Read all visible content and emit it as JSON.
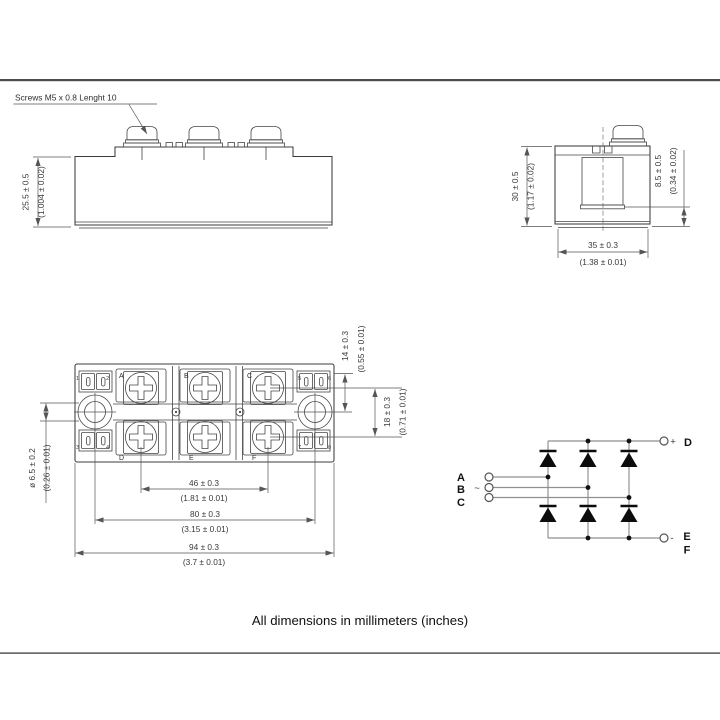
{
  "page": {
    "note_screws": "Screws M5 x 0.8 Lenght 10",
    "caption": "All dimensions in millimeters (inches)"
  },
  "colors": {
    "line": "#3c3c3c",
    "dim": "#555555",
    "wire": "#8f8f8f",
    "ink": "#111111"
  },
  "side_view": {
    "height_mm": "25.5 ± 0.5",
    "height_in": "(1.004 ± 0.02)"
  },
  "end_view": {
    "height_mm": "30 ± 0.5",
    "height_in": "(1.17 ± 0.02)",
    "tab_mm": "8.5 ± 0.5",
    "tab_in": "(0.34 ± 0.02)",
    "width_mm": "35 ± 0.3",
    "width_in": "(1.38 ± 0.01)"
  },
  "top_view": {
    "terminals": [
      "A",
      "B",
      "C",
      "D",
      "E",
      "F"
    ],
    "pins": [
      "1",
      "2",
      "3",
      "4",
      "5",
      "6",
      "7",
      "8"
    ],
    "hole_mm": "ø 6.5 ± 0.2",
    "hole_in": "(0.26 ± 0.01)",
    "tab_offset_mm": "14 ± 0.3",
    "tab_offset_in": "(0.55 ± 0.01)",
    "row_pitch_mm": "18 ± 0.3",
    "row_pitch_in": "(0.71 ± 0.01)",
    "span46_mm": "46 ± 0.3",
    "span46_in": "(1.81 ± 0.01)",
    "span80_mm": "80 ± 0.3",
    "span80_in": "(3.15 ± 0.01)",
    "span94_mm": "94 ± 0.3",
    "span94_in": "(3.7 ± 0.01)"
  },
  "circuit": {
    "phases": [
      "A",
      "B",
      "C"
    ],
    "ac_symbol": "~",
    "plus_sign": "+",
    "minus_sign": "-",
    "dc_plus": "D",
    "dc_minus": [
      "E",
      "F"
    ]
  }
}
